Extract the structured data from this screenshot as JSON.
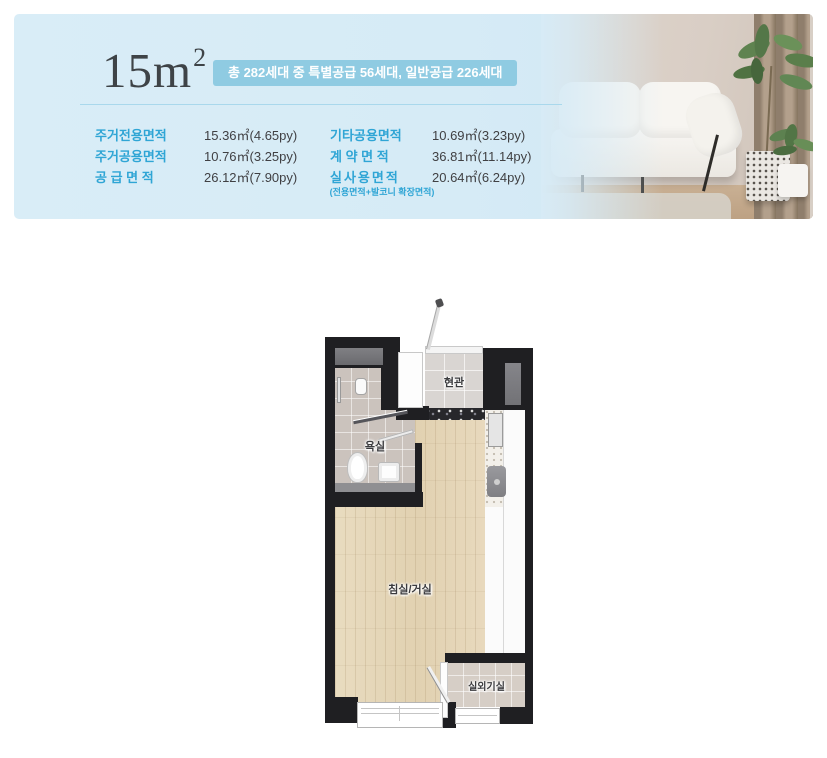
{
  "header": {
    "size_label": "15m",
    "size_sup": "2",
    "badge": "총 282세대 중 특별공급 56세대, 일반공급 226세대",
    "table": {
      "left": [
        {
          "label": "주거전용면적",
          "value": "15.36㎡(4.65py)"
        },
        {
          "label": "주거공용면적",
          "value": "10.76㎡(3.25py)"
        },
        {
          "label": "공 급 면 적",
          "value": "26.12㎡(7.90py)"
        }
      ],
      "right": [
        {
          "label": "기타공용면적",
          "value": "10.69㎡(3.23py)"
        },
        {
          "label": "계 약 면 적",
          "value": "36.81㎡(11.14py)"
        },
        {
          "label": "실사용면적",
          "value": "20.64㎡(6.24py)"
        }
      ],
      "note": "(전용면적+발코니 확장면적)"
    },
    "colors": {
      "panel_bg": "#d8ecf7",
      "badge_bg": "#8fcbe2",
      "accent_label": "#2fa5d5",
      "value_text": "#404043",
      "title_text": "#3e4347",
      "divider": "#a9d8ec"
    }
  },
  "floorplan": {
    "labels": {
      "entry": "현관",
      "bath": "욕실",
      "living": "침실/거실",
      "outdoor": "실외기실"
    },
    "wall_color": "#1f1f22"
  },
  "photo": {
    "description": "white sofa with green potted plants, beige wall and brown curtain"
  }
}
